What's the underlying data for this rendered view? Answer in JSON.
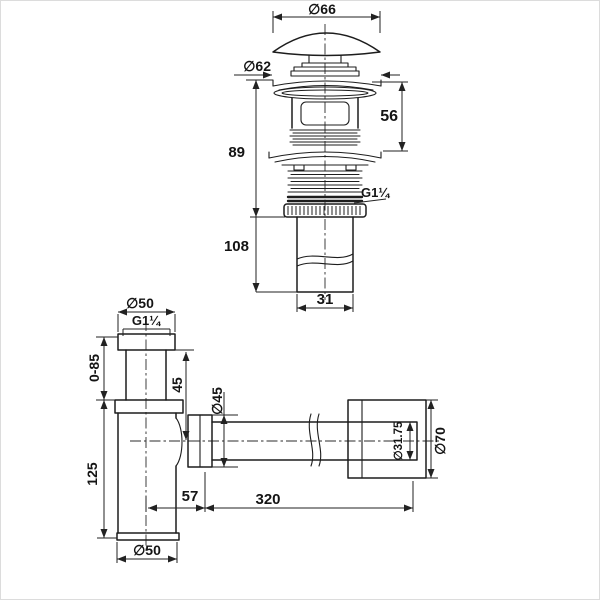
{
  "drawing_type": "technical dimension drawing",
  "subject": "basin pop-up waste drain and bottle trap siphon",
  "colors": {
    "background": "#ffffff",
    "ink": "#1d1d1d"
  },
  "labels": {
    "popup": {
      "cap_dia": "∅66",
      "flange_dia": "∅62",
      "upper_height": "56",
      "overall_height": "89",
      "thread": "G1¼",
      "tail_length": "108",
      "tail_width": "31"
    },
    "trap": {
      "inlet_nut_dia": "∅50",
      "inlet_thread": "G1¼",
      "adjust_range": "0-85",
      "inlet_exposed": "45",
      "outlet_nut_dia": "∅45",
      "body_height": "125",
      "outlet_offset": "57",
      "pipe_length": "320",
      "pipe_dia": "∅31.75",
      "escutcheon_dia": "∅70",
      "body_dia": "∅50"
    }
  }
}
